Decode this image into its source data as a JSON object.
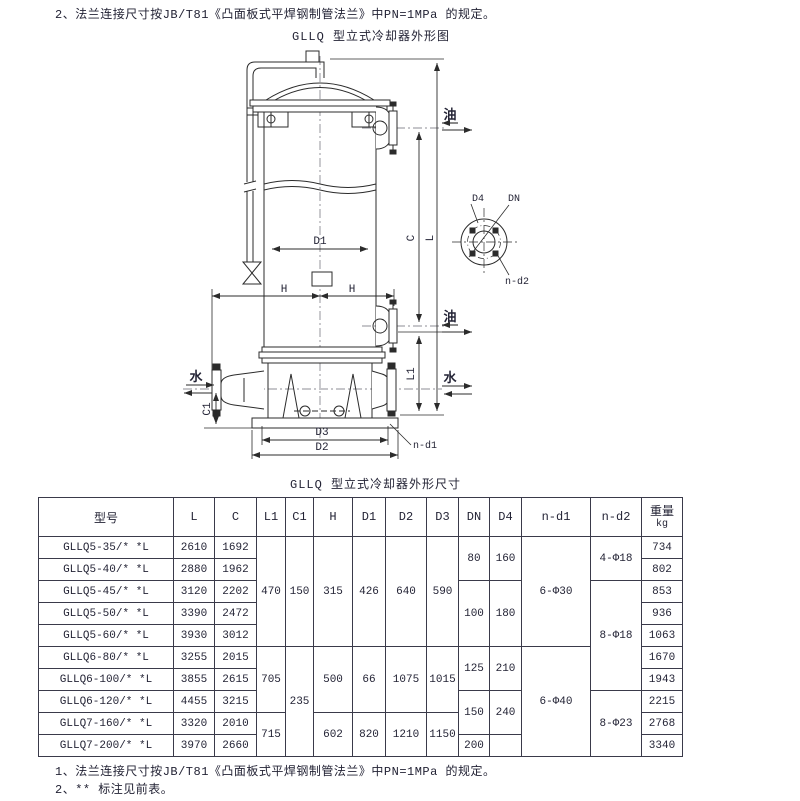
{
  "page": {
    "note_top": "2、法兰连接尺寸按JB/T81《凸面板式平焊钢制管法兰》中PN=1MPa 的规定。",
    "note_bottom_1": "1、法兰连接尺寸按JB/T81《凸面板式平焊钢制管法兰》中PN=1MPa 的规定。",
    "note_bottom_2": "2、** 标注见前表。"
  },
  "diagram": {
    "title": "GLLQ 型立式冷却器外形图",
    "labels": {
      "oil": "油",
      "water": "水",
      "d1": "D1",
      "h": "H",
      "c": "C",
      "l": "L",
      "l1": "L1",
      "c1": "C1",
      "d2": "D2",
      "d3": "D3",
      "n_d1": "n-d1",
      "d4": "D4",
      "dn": "DN",
      "n_d2": "n-d2"
    }
  },
  "table": {
    "title": "GLLQ 型立式冷却器外形尺寸",
    "headers": {
      "model": "型号",
      "l": "L",
      "c": "C",
      "l1": "L1",
      "c1": "C1",
      "h": "H",
      "d1": "D1",
      "d2": "D2",
      "d3": "D3",
      "dn": "DN",
      "d4": "D4",
      "n_d1": "n-d1",
      "n_d2": "n-d2",
      "weight": "重量",
      "weight_unit": "kg"
    },
    "models": [
      "GLLQ5-35/* *L",
      "GLLQ5-40/* *L",
      "GLLQ5-45/* *L",
      "GLLQ5-50/* *L",
      "GLLQ5-60/* *L",
      "GLLQ6-80/* *L",
      "GLLQ6-100/* *L",
      "GLLQ6-120/* *L",
      "GLLQ7-160/* *L",
      "GLLQ7-200/* *L"
    ],
    "L": [
      "2610",
      "2880",
      "3120",
      "3390",
      "3930",
      "3255",
      "3855",
      "4455",
      "3320",
      "3970"
    ],
    "C": [
      "1692",
      "1962",
      "2202",
      "2472",
      "3012",
      "2015",
      "2615",
      "3215",
      "2010",
      "2660"
    ],
    "L1": [
      "470",
      "705",
      "715"
    ],
    "C1": [
      "150",
      "235"
    ],
    "H": [
      "315",
      "500",
      "602"
    ],
    "D1": [
      "426",
      "66",
      "820"
    ],
    "D2": [
      "640",
      "1075",
      "1210"
    ],
    "D3": [
      "590",
      "1015",
      "1150"
    ],
    "DN": [
      "80",
      "100",
      "125",
      "150",
      "200"
    ],
    "D4": [
      "160",
      "180",
      "210",
      "240",
      ""
    ],
    "n_d1": [
      "6-Φ30",
      "6-Φ40"
    ],
    "n_d2": [
      "4-Φ18",
      "8-Φ18",
      "8-Φ23"
    ],
    "weights": [
      "734",
      "802",
      "853",
      "936",
      "1063",
      "1670",
      "1943",
      "2215",
      "2768",
      "3340"
    ]
  }
}
